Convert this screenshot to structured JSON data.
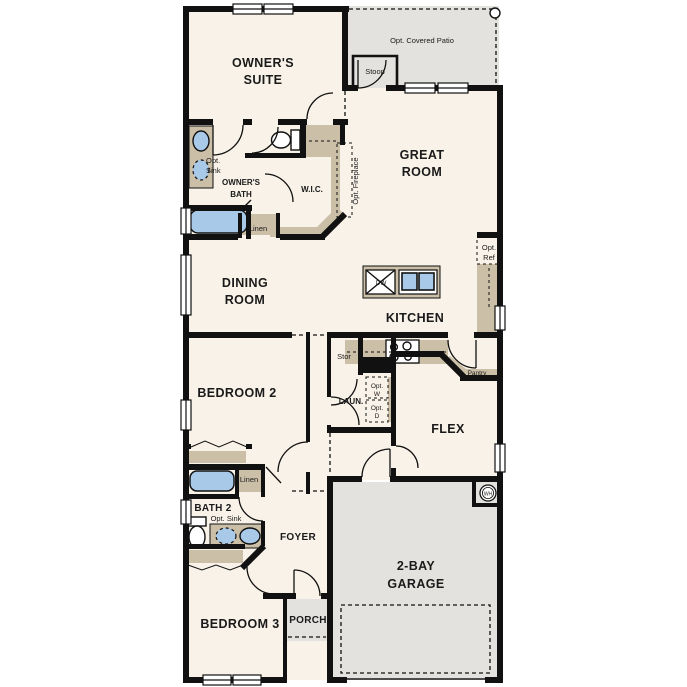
{
  "title": "single-story floor plan",
  "colors": {
    "floor": "#f8f2e8",
    "outdoor": "#e3e2df",
    "casework": "#cbbfa7",
    "fixture_blue": "#a9c9e9",
    "wall": "#111111",
    "background": "#ffffff"
  },
  "labels": {
    "owners_suite_1": "OWNER'S",
    "owners_suite_2": "SUITE",
    "opt_covered_patio": "Opt. Covered Patio",
    "stoop": "Stoop",
    "great_room_1": "GREAT",
    "great_room_2": "ROOM",
    "owners_bath_1": "OWNER'S",
    "owners_bath_2": "BATH",
    "opt_sink_v_1": "Opt.",
    "opt_sink_v_2": "Sink",
    "wic": "W.I.C.",
    "linen_upper": "Linen",
    "opt_fireplace": "Opt. Fireplace",
    "dining_1": "DINING",
    "dining_2": "ROOM",
    "kitchen": "KITCHEN",
    "dw": "DW",
    "opt_ref_1": "Opt.",
    "opt_ref_2": "Ref",
    "pantry": "Pantry",
    "stor": "Stor",
    "laun": "LAUN.",
    "opt_w_1": "Opt.",
    "opt_w_2": "W",
    "opt_d_1": "Opt.",
    "opt_d_2": "D",
    "bedroom2": "BEDROOM 2",
    "flex": "FLEX",
    "bath2": "BATH 2",
    "opt_sink_h": "Opt. Sink",
    "linen_lower": "Linen",
    "foyer": "FOYER",
    "garage_1": "2-BAY",
    "garage_2": "GARAGE",
    "wh": "WH",
    "porch": "PORCH",
    "bedroom3": "BEDROOM 3"
  }
}
